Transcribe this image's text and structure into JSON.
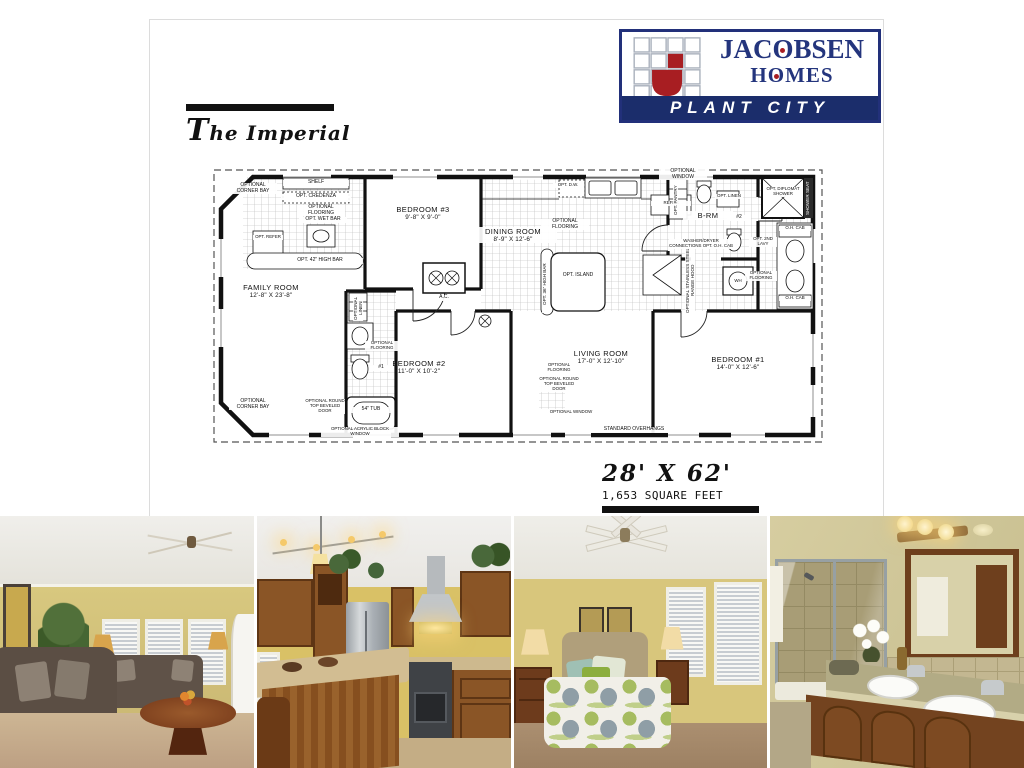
{
  "page": {
    "title": "The Imperial",
    "size_label": "28' X 62'",
    "sqft_label": "1,653 SQUARE FEET"
  },
  "logo": {
    "brand_line1": "JACOBSEN",
    "brand_line2": "HOMES",
    "banner": "PLANT CITY",
    "navy": "#22307a",
    "red": "#a81e22"
  },
  "floor_plan": {
    "rooms": [
      {
        "name": "FAMILY ROOM",
        "dims": "12'-8\" X 23'-8\""
      },
      {
        "name": "BEDROOM #3",
        "dims": "9'-8\" X 9'-0\""
      },
      {
        "name": "DINING ROOM",
        "dims": "8'-9\" X 12'-6\""
      },
      {
        "name": "LIVING ROOM",
        "dims": "17'-0\" X 12'-10\""
      },
      {
        "name": "BEDROOM #2",
        "dims": "11'-0\" X 10'-2\""
      },
      {
        "name": "BEDROOM #1",
        "dims": "14'-0\" X 12'-6\""
      },
      {
        "name": "B-RM",
        "dims": ""
      }
    ],
    "labels": [
      {
        "text": "OPTIONAL CORNER BAY"
      },
      {
        "text": "SHELF"
      },
      {
        "text": "OPT. CREDENZA"
      },
      {
        "text": "OPTIONAL FLOORING"
      },
      {
        "text": "OPT. WET BAR"
      },
      {
        "text": "OPT. REFER"
      },
      {
        "text": "OPT. 42\" HIGH BAR"
      },
      {
        "text": "A.C."
      },
      {
        "text": "OPT. D.W."
      },
      {
        "text": "REFER"
      },
      {
        "text": "OPT. 36\" HIGH BAR"
      },
      {
        "text": "OPT. ISLAND"
      },
      {
        "text": "OPTIONAL STAINLESS STEEL RANGE HOOD"
      },
      {
        "text": "OPTIONAL FLOORING"
      },
      {
        "text": "OPTIONAL WINDOW"
      },
      {
        "text": "OPT. PANTRY"
      },
      {
        "text": "WASHER/DRYER CONNECTIONS OPT. O.H. CAB"
      },
      {
        "text": "OPT. LINEN"
      },
      {
        "text": "#2"
      },
      {
        "text": "OPT. DIPLOMAT SHOWER"
      },
      {
        "text": "SHOWER SEAT"
      },
      {
        "text": "OPT. 2ND LAVY"
      },
      {
        "text": "OPTIONAL FLOORING"
      },
      {
        "text": "O.H. CAB"
      },
      {
        "text": "O.H. CAB"
      },
      {
        "text": "WH"
      },
      {
        "text": "OPTIONAL LINEN"
      },
      {
        "text": "OPTIONAL FLOORING"
      },
      {
        "text": "#1"
      },
      {
        "text": "54\" TUB"
      },
      {
        "text": "OPTIONAL CORNER BAY"
      },
      {
        "text": "OPTIONAL ROUND TOP BEVELED DOOR"
      },
      {
        "text": "OPTIONAL FLOORING"
      },
      {
        "text": "OPTIONAL ROUND TOP BEVELED DOOR"
      },
      {
        "text": "OPTIONAL ACRYLIC BLOCK WINDOW"
      },
      {
        "text": "OPTIONAL WINDOW"
      },
      {
        "text": "STANDARD OVERHANGS"
      }
    ]
  },
  "photos": [
    {
      "description": "living room"
    },
    {
      "description": "kitchen"
    },
    {
      "description": "bedroom"
    },
    {
      "description": "bathroom"
    }
  ]
}
